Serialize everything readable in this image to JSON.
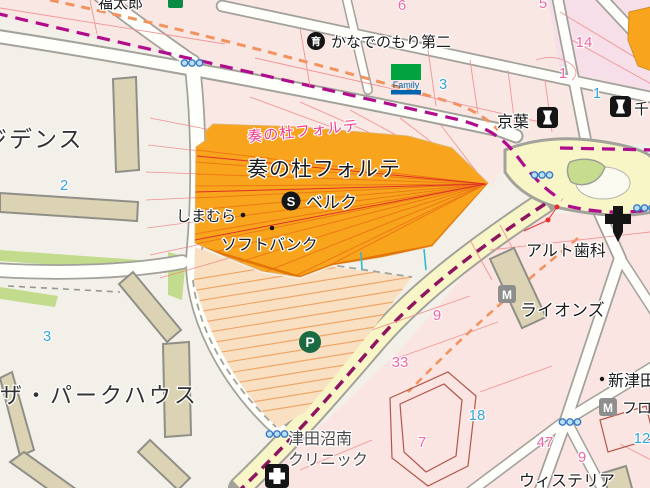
{
  "map": {
    "type": "japanese-street-map",
    "colors": {
      "highlight_building": "#F8A41D",
      "boundary_magenta": "#B00D8C",
      "boundary_salmon": "#F2935E",
      "road_major_fill": "#F8F5C6",
      "block_pink": "#F9E5E1",
      "block_base": "#F3F0E9",
      "building_tan": "#DBD3B3",
      "number_blue": "#35A4D8",
      "number_pink": "#F166A4",
      "parking_fill": "#F9E0C2",
      "green_island": "#C8DC90"
    },
    "labels": {
      "fukutaro": "福太郎",
      "paren": "）",
      "residence": "ジデンス",
      "nursery_glyph": "育",
      "kanade_daini": "かなでのもり第二",
      "family": "Family",
      "keiyo": "京葉",
      "chiba": "千",
      "forte_area_pink": "奏の杜フォルテ",
      "forte_building": "奏の杜フォルテ",
      "s_glyph": "S",
      "belc": "ベルク",
      "shimamura": "しまむら",
      "softbank": "ソフトバンク",
      "parkhouse": "ザ・パークハウス",
      "alto": "アルト歯科",
      "m_glyph": "M",
      "lions": "ライオンズ",
      "shintsuda": "新津田",
      "furo": "フロー",
      "p_glyph": "P",
      "clinic_line1": "津田沼南",
      "clinic_line2": "クリニック",
      "wisteria": "ウィステリア"
    },
    "numbers": [
      {
        "value": "2",
        "color": "blue"
      },
      {
        "value": "3",
        "color": "blue"
      },
      {
        "value": "3",
        "color": "blue"
      },
      {
        "value": "18",
        "color": "blue"
      },
      {
        "value": "12",
        "color": "blue"
      },
      {
        "value": "1",
        "color": "blue"
      },
      {
        "value": "6",
        "color": "pink"
      },
      {
        "value": "5",
        "color": "pink"
      },
      {
        "value": "14",
        "color": "pink"
      },
      {
        "value": "1",
        "color": "pink"
      },
      {
        "value": "9",
        "color": "pink"
      },
      {
        "value": "33",
        "color": "pink"
      },
      {
        "value": "7",
        "color": "pink"
      },
      {
        "value": "47",
        "color": "pink"
      },
      {
        "value": "9",
        "color": "pink"
      }
    ]
  }
}
